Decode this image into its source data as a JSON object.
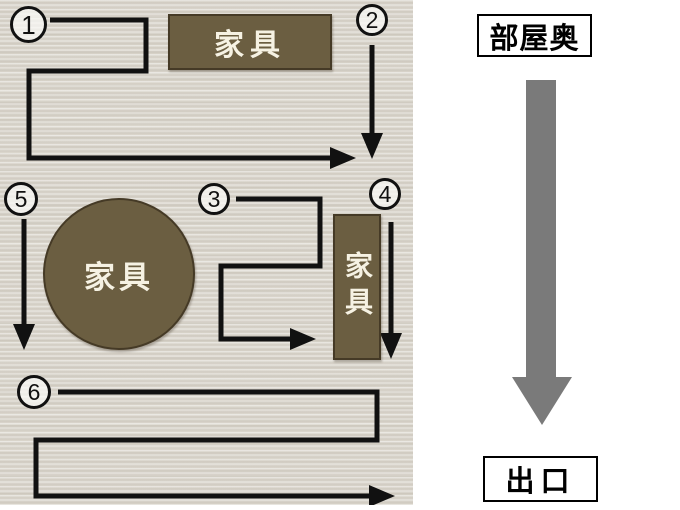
{
  "legend": {
    "room_back_label": "部屋奥",
    "exit_label": "出口"
  },
  "room": {
    "furniture": {
      "shelf_top_label": "家具",
      "round_table_label": "家具",
      "side_cabinet_label": "家具"
    },
    "steps": [
      "1",
      "2",
      "3",
      "4",
      "5",
      "6"
    ]
  },
  "colors": {
    "furniture_brown": "#6b5e41",
    "floor_light_wood": "#ddd9d0",
    "route_path_black": "#111111",
    "direction_arrow_gray": "#7a7a7a"
  }
}
